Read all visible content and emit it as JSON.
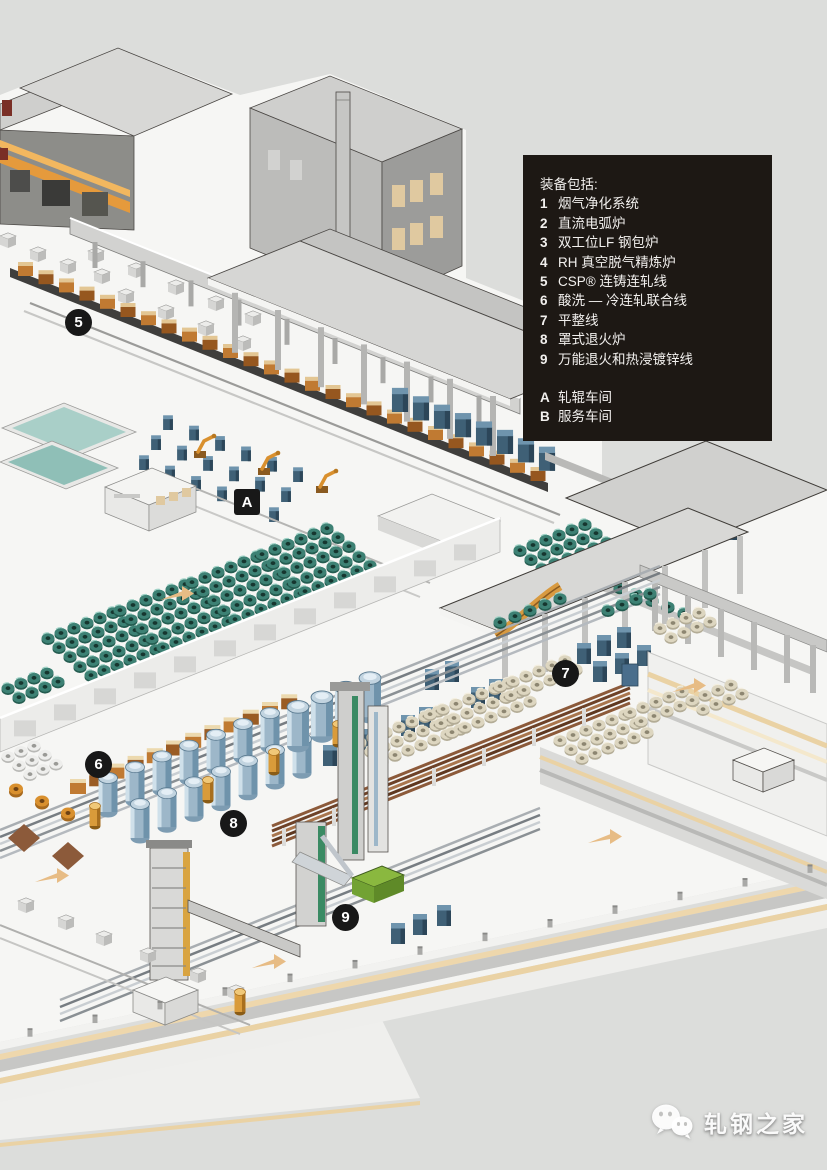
{
  "legend": {
    "title": "装备包括:",
    "items": [
      {
        "key": "1",
        "label": "烟气净化系统"
      },
      {
        "key": "2",
        "label": "直流电弧炉"
      },
      {
        "key": "3",
        "label": "双工位LF 钢包炉"
      },
      {
        "key": "4",
        "label": "RH 真空脱气精炼炉"
      },
      {
        "key": "5",
        "label": "CSP® 连铸连轧线"
      },
      {
        "key": "6",
        "label": "酸洗 — 冷连轧联合线"
      },
      {
        "key": "7",
        "label": "平整线"
      },
      {
        "key": "8",
        "label": "罩式退火炉"
      },
      {
        "key": "9",
        "label": "万能退火和热浸镀锌线"
      }
    ],
    "areas": [
      {
        "key": "A",
        "label": "轧辊车间"
      },
      {
        "key": "B",
        "label": "服务车间"
      }
    ]
  },
  "markers": [
    {
      "label": "5",
      "shape": "circle",
      "x": 78,
      "y": 322
    },
    {
      "label": "A",
      "shape": "square",
      "x": 247,
      "y": 502
    },
    {
      "label": "7",
      "shape": "circle",
      "x": 565,
      "y": 673
    },
    {
      "label": "6",
      "shape": "circle",
      "x": 98,
      "y": 764
    },
    {
      "label": "8",
      "shape": "circle",
      "x": 233,
      "y": 823
    },
    {
      "label": "9",
      "shape": "circle",
      "x": 345,
      "y": 917
    }
  ],
  "watermark": {
    "icon": "wechat-icon",
    "text": "轧钢之家"
  },
  "colors": {
    "bg": "#dcdddb",
    "legend-bg": "#1d1814",
    "legend-text": "#f2f0ee",
    "marker-bg": "#181818",
    "marker-text": "#ffffff",
    "platform": "#f6f6f4",
    "accent-orange": "#d9902e",
    "coil-teal": "#3d8174",
    "coil-beige": "#ddd6c0",
    "machine-blue": "#3f6076",
    "furnace-copper": "#8c5a3a",
    "zinc-green": "#8ab83f",
    "stripe-tan": "#ead2a4"
  }
}
